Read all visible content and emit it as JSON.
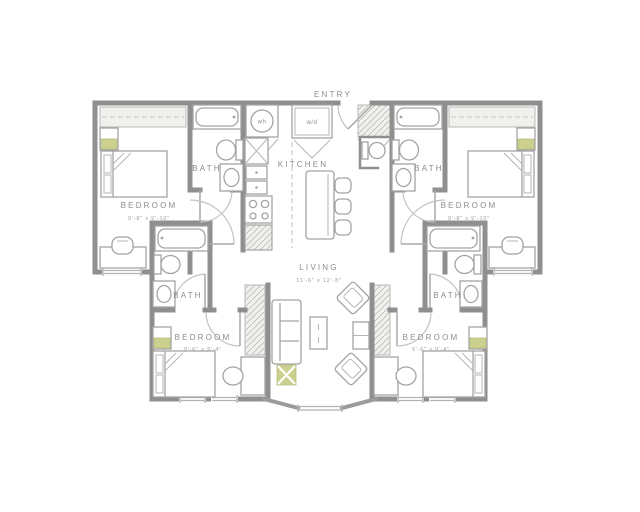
{
  "floorplan": {
    "type": "apartment-floor-plan",
    "rooms": {
      "entry": {
        "label": "ENTRY"
      },
      "kitchen": {
        "label": "KITCHEN"
      },
      "living": {
        "label": "LIVING",
        "dims": "11'-6\" x 12'-8\""
      },
      "bedroom_tl": {
        "label": "BEDROOM",
        "dims": "9'-8\" x 9'-10\""
      },
      "bedroom_tr": {
        "label": "BEDROOM",
        "dims": "9'-8\" x 9'-10\""
      },
      "bedroom_bl": {
        "label": "BEDROOM",
        "dims": "9'-6\" x 9'-4\""
      },
      "bedroom_br": {
        "label": "BEDROOM",
        "dims": "9'-6\" x 9'-4\""
      },
      "bath_tl": {
        "label": "BATH"
      },
      "bath_tr": {
        "label": "BATH"
      },
      "bath_ml": {
        "label": "BATH"
      },
      "bath_mr": {
        "label": "BATH"
      }
    },
    "appliances": {
      "water_heater_label": "wh",
      "washer_dryer_label": "w/d"
    },
    "colors": {
      "wall": "#8f8f8f",
      "fixture_stroke": "#a3a3a3",
      "closet_fill": "#f1f0ed",
      "accent_olive": "#ccd08f",
      "label_text": "#8c8c8c"
    }
  }
}
